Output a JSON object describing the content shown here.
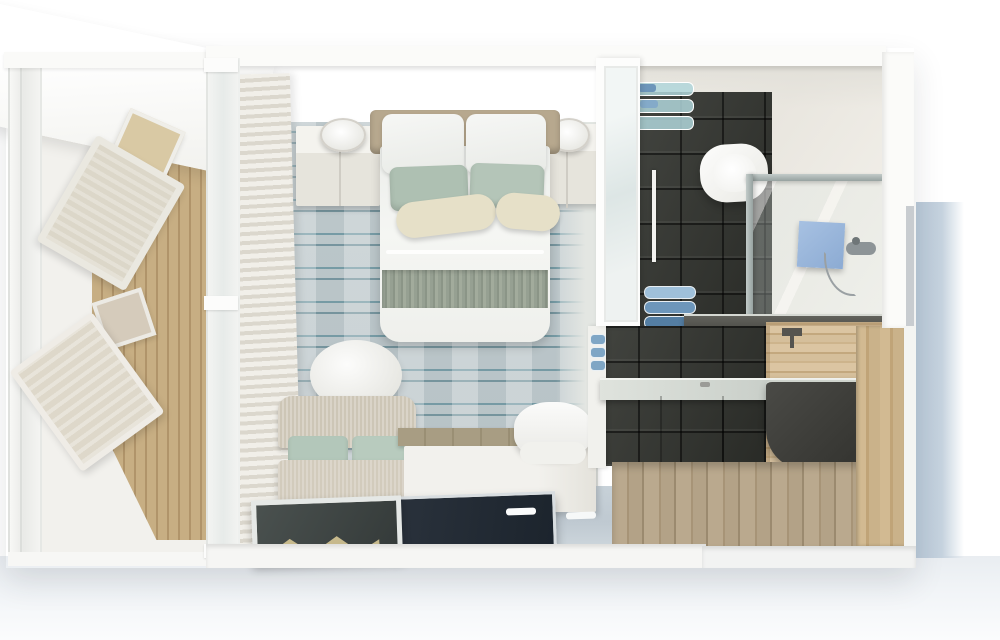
{
  "scene": {
    "type": "3d-floorplan-render",
    "view": "top-down-cutaway",
    "rooms": [
      {
        "name": "balcony",
        "items": [
          "glass-railing",
          "awning",
          "wood-decking",
          "deck-table",
          "deck-chair",
          "deck-lounger",
          "side-table"
        ]
      },
      {
        "name": "bedroom",
        "items": [
          "sliding-window-wall",
          "curtains",
          "headboard-wall",
          "double-bed",
          "white-pillows",
          "sage-pillows",
          "cream-bolsters",
          "duvet",
          "foot-runner",
          "nightstand-left",
          "wall-sconce-left",
          "nightstand-right",
          "wall-sconce-right",
          "striped-carpet",
          "oval-pouf",
          "sofa",
          "console-desk",
          "desk-chair",
          "tv-screen",
          "glass-coffee-table",
          "glass-floor-panel"
        ]
      },
      {
        "name": "bathroom",
        "items": [
          "glass-door",
          "glass-shelves",
          "teal-towels",
          "toilet",
          "walk-in-shower",
          "shower-glass-partition",
          "blue-shower-mat",
          "shower-fixture",
          "towel-rail",
          "blue-towel-stack",
          "half-wall-ledge",
          "dark-tile-walls",
          "vanity-counter",
          "dark-sink",
          "wood-accent-wall",
          "wall-faucet",
          "wood-plank-floor"
        ]
      }
    ]
  },
  "palette": {
    "carpet_base": "#bcc7ca",
    "carpet_streak": "#3e7887",
    "wood_balcony": "#c7ae83",
    "wood_balcony_dark": "#b0946a",
    "wood_wall": "#dbc5a2",
    "wood_wall_dark": "#c3a87e",
    "wood_floor": "#baa98e",
    "wood_floor_dark": "#9b8a6f",
    "tile_dark": "#32342f",
    "linen": "#cdc6b6",
    "sage": "#aec0b2",
    "cream": "#e6e0c8",
    "runner": "#96a092",
    "headboard_tan": "#b7a88e",
    "wall_white": "#fbfbf9",
    "glass_teal": "#bcd9dd",
    "towel_blue": "#6d96ba",
    "shower_blue": "#8cabd3",
    "tv_dark": "#1c242d",
    "counter_dark": "#5c5953",
    "exterior_blue": "#b9c9d8",
    "glass_panel": "#c7d1d8"
  }
}
